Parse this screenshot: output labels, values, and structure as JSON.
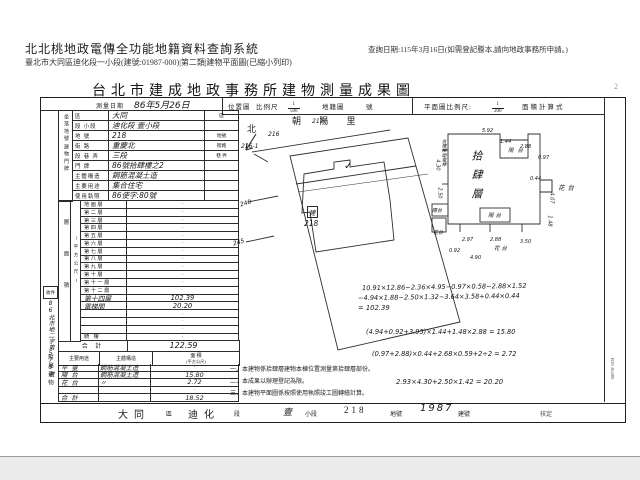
{
  "viewer": {
    "system_title": "北北桃地政電傳全功能地籍資料查詢系統",
    "subtitle": "臺北市大同區迪化段一小段(建號:01987-000)|第二類|建物平面圖(已縮小列印)",
    "query_date": "查詢日期:115年3月16日(如需登記謄本,請向地政事務所申請。)"
  },
  "doc": {
    "title": "台北市建成地政事務所建物測量成果圖",
    "page_marker": "2",
    "form_code": "R26 30,000",
    "header": {
      "survey_date_label": "測量日期",
      "survey_date_value": "86年5月26日",
      "location_map_label": "位置圖",
      "scale_label": "比例尺",
      "location_scale_num": "1",
      "location_scale_den": "500",
      "cadastral_label": "地籍圖",
      "cadastral_no_label": "號",
      "plan_scale_label": "平面圖比例尺:",
      "plan_scale_num": "1",
      "plan_scale_den": "200",
      "area_calc_label": "面積計算式"
    },
    "left_strip": {
      "receipt_label": "收件",
      "receipt_no": "86北市地二字第575號",
      "annex_label": "附屬建物"
    },
    "site": {
      "group1": "坐落地號",
      "group2": "建物門牌",
      "rows": [
        {
          "label": "區",
          "value": "大同",
          "suffix": "區"
        },
        {
          "label": "段 小段",
          "value": "迪化段 壹小段",
          "suffix": ""
        },
        {
          "label": "地 號",
          "value": "218",
          "suffix": "地號"
        },
        {
          "label": "街 路",
          "value": "重慶北",
          "suffix": "街路"
        },
        {
          "label": "段 巷 弄",
          "value": "三段",
          "suffix": "巷 弄"
        },
        {
          "label": "門 牌",
          "value": "86號拾肆樓之2",
          "suffix": ""
        },
        {
          "label": "主體構造",
          "value": "鋼筋混凝土造",
          "suffix": ""
        },
        {
          "label": "主要用途",
          "value": "集合住宅",
          "suffix": ""
        },
        {
          "label": "使用執照",
          "value": "86使字:80號",
          "suffix": ""
        }
      ]
    },
    "floors": {
      "strip_label": "層面積",
      "strip_sublabel": "(平方公尺)",
      "rows": [
        {
          "label": "地面層",
          "value": "·",
          "cls": ""
        },
        {
          "label": "第二層",
          "value": "·",
          "cls": ""
        },
        {
          "label": "第三層",
          "value": "·",
          "cls": ""
        },
        {
          "label": "第四層",
          "value": "·",
          "cls": ""
        },
        {
          "label": "第五層",
          "value": "·",
          "cls": ""
        },
        {
          "label": "第六層",
          "value": "·",
          "cls": ""
        },
        {
          "label": "第七層",
          "value": "·",
          "cls": ""
        },
        {
          "label": "第八層",
          "value": "·",
          "cls": ""
        },
        {
          "label": "第九層",
          "value": "·",
          "cls": ""
        },
        {
          "label": "第十層",
          "value": "·",
          "cls": ""
        },
        {
          "label": "第十一層",
          "value": "·",
          "cls": ""
        },
        {
          "label": "第十二層",
          "value": "·",
          "cls": ""
        },
        {
          "label": "第十四層",
          "value": "102.39",
          "cls": "hand"
        },
        {
          "label": "電梯間",
          "value": "20.20",
          "cls": "hand"
        },
        {
          "label": "",
          "value": "·",
          "cls": ""
        },
        {
          "label": "",
          "value": "·",
          "cls": ""
        },
        {
          "label": "",
          "value": "·",
          "cls": ""
        },
        {
          "label": "騎 樓",
          "value": "·",
          "cls": ""
        }
      ],
      "total_label": "合 計",
      "total_value": "122.59"
    },
    "annex": {
      "header_use": "主要用途",
      "header_structure": "主體構造",
      "header_area": "面 積",
      "header_area_unit": "(平方公尺)",
      "rows": [
        {
          "use": "平 臺",
          "structure": "鋼筋混凝土造",
          "area": "·",
          "cls": ""
        },
        {
          "use": "陽 台",
          "structure": "鋼筋混凝土造",
          "area": "15.80",
          "cls": "hand"
        },
        {
          "use": "花 台",
          "structure": "〃",
          "area": "2.72",
          "cls": "hand"
        },
        {
          "use": "",
          "structure": "",
          "area": "·",
          "cls": ""
        },
        {
          "use": "合 計",
          "structure": "",
          "area": "18.52",
          "cls": "hand"
        }
      ]
    },
    "map": {
      "village": "朝 陽 里",
      "north": "北",
      "lot217": "217",
      "lot216": "216",
      "lot216_1": "216-1",
      "lot240": "240",
      "lot245": "245",
      "lot_main": "218",
      "build_mark": "建",
      "check_mark": "✓"
    },
    "plan": {
      "floor_label": "拾肆層",
      "left_note": "含樓梯間電梯",
      "balcony_top": "陽台",
      "flower_right": "花台",
      "balcony_bottom": "陽台",
      "flower_bottom": "花台",
      "balcony_left": "陽台",
      "flower_left": "花台",
      "dims": [
        "5.92",
        "1.44",
        "2.88",
        "0.97",
        "0.44",
        "4.07",
        "1.48",
        "2.97",
        "2.88",
        "3.50",
        "0.92",
        "4.90",
        "2.50",
        "4.30"
      ]
    },
    "formulas": [
      "10.91×12.86−2.36×4.95−0.97×0.58−2.88×1.52",
      "−4.94×1.88−2.50×1.32−3.64×3.58+0.44×0.44",
      "= 102.39",
      "(4.94+0.92+3.95)×1.44+1.48×2.88 = 15.80",
      "(0.97+2.88)×0.44+2.68×0.59+2÷2 = 2.72",
      "2.93×4.30+2.50×1.42 = 20.20"
    ],
    "notes": [
      "一、本建物係拾肆層建物本棟位置測量第拾肆層部份。",
      "二、本成果以辦理登記為限。",
      "三、本建物平面圖係按照使用執照竣工圖轉繪計算。"
    ],
    "footer": {
      "district": "大同",
      "district_suffix": "區",
      "section": "迪化",
      "section_suffix": "段",
      "subsection": "壹",
      "subsection_suffix": "小段",
      "lot": "218",
      "lot_suffix": "地號",
      "building_no": "1987",
      "building_suffix": "建號",
      "approve": "核定"
    }
  }
}
